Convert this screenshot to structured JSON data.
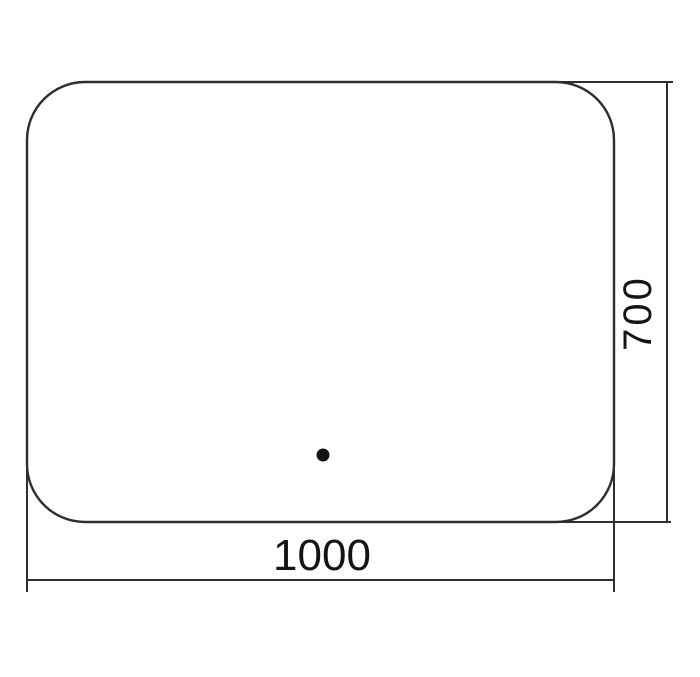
{
  "drawing": {
    "type": "dimension-drawing",
    "shape": "rounded-rectangle",
    "width_label": "1000",
    "height_label": "700",
    "dot_visible": true,
    "colors": {
      "line": "#2e2e2e",
      "text": "#141414",
      "background": "#ffffff"
    }
  }
}
